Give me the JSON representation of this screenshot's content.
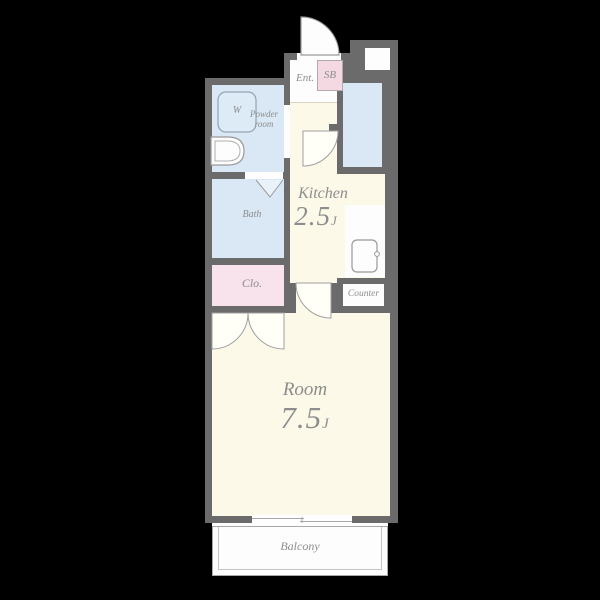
{
  "colors": {
    "background": "#000000",
    "wall": "#6b6b6b",
    "floor_cream": "#fcf9e9",
    "floor_blue": "#d9e8f4",
    "floor_pink_sb": "#f4d9e2",
    "floor_pink_closet": "#f8e2eb",
    "floor_white": "#fdfdfd",
    "label_gray": "#8d8d8d"
  },
  "rooms": {
    "entrance": {
      "label": "Ent."
    },
    "shoe_box": {
      "label": "SB"
    },
    "powder_room": {
      "label_line1": "Powder",
      "label_line2": "room"
    },
    "washer": {
      "label": "W"
    },
    "bath": {
      "label": "Bath"
    },
    "closet": {
      "label": "Clo."
    },
    "kitchen": {
      "label": "Kitchen",
      "size": "2.5",
      "size_unit": "J"
    },
    "counter": {
      "label": "Counter"
    },
    "main_room": {
      "label": "Room",
      "size": "7.5",
      "size_unit": "J"
    },
    "balcony": {
      "label": "Balcony"
    }
  },
  "fixtures": {
    "washing_machine_icon": "washer-box",
    "sink_icon": "vanity-basin",
    "refrigerator_icon": "fridge",
    "entrance_door_icon": "swing-door",
    "kitchen_door_icon": "swing-door",
    "room_door_icon": "swing-door",
    "closet_door_icon": "double-swing-door",
    "bath_door_icon": "folding-door-chevron",
    "window_icon": "sliding-window"
  }
}
